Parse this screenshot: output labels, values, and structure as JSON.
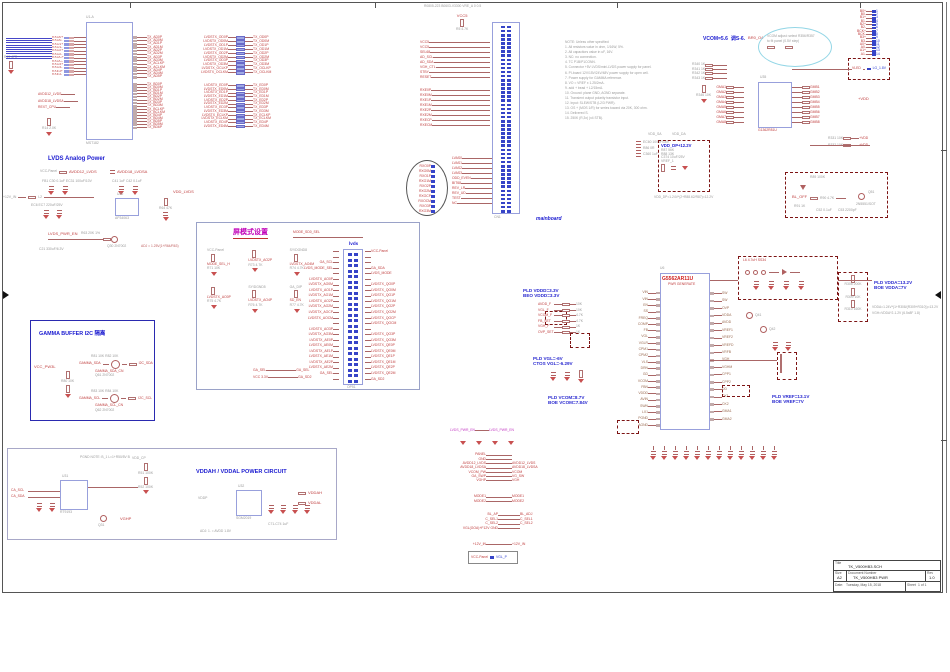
{
  "sheet": {
    "edge_res": "R19 47R"
  },
  "top_left_ic": {
    "ref": "U1-A",
    "part": "MST182",
    "bus_rows": 10,
    "left_rows": [
      {
        "l": "RXO0+"
      },
      {
        "l": "RXO0-"
      },
      {
        "l": "RXO1+"
      },
      {
        "l": "RXO1-"
      },
      {
        "l": "RXO2+"
      },
      {
        "l": "RXO2-"
      },
      {
        "l": "RXOC+"
      },
      {
        "l": "RXOC-"
      },
      {
        "l": "RXO3+"
      },
      {
        "l": "RXO3-"
      },
      {
        "l": "RXE3+"
      },
      {
        "l": "RXE3-"
      }
    ],
    "left_nets": [
      "AVDD12_LVDS",
      "AVDD18_LVDSA",
      "REXT_CPU"
    ],
    "rext": "R14 2.0K",
    "right1": [
      "TX_AD0P",
      "TX_AD0M",
      "TX_AD1P",
      "TX_AD1M",
      "TX_AD2P",
      "TX_AD2M",
      "TX_AD3P",
      "TX_AD3M",
      "TX_ACLKP",
      "TX_ACLKM",
      "TX_AD4P",
      "TX_AD4M",
      "TX_AD5P"
    ],
    "right2": [
      "TX_BD0P",
      "TX_BD0M",
      "TX_BD1P",
      "TX_BD1M",
      "TX_BD2P",
      "TX_BD2M",
      "TX_BD3P",
      "TX_BD3M",
      "TX_BCLKP",
      "TX_BCLKM",
      "TX_BD4P",
      "TX_BD4M",
      "TX_BD5P",
      "TX_BD5M",
      "TX_BD6P"
    ]
  },
  "rn1": [
    {
      "l": "LVDSTX_OD0P",
      "r": "TX_OD0P"
    },
    {
      "l": "LVDSTX_OD0M",
      "r": "TX_OD0M"
    },
    {
      "l": "LVDSTX_OD1P",
      "r": "TX_OD1P"
    },
    {
      "l": "LVDSTX_OD1M",
      "r": "TX_OD1M"
    },
    {
      "l": "LVDSTX_OD2P",
      "r": "TX_OD2P"
    },
    {
      "l": "LVDSTX_OD2M",
      "r": "TX_OD2M"
    },
    {
      "l": "LVDSTX_OD3P",
      "r": "TX_OD3P"
    },
    {
      "l": "LVDSTX_OD3M",
      "r": "TX_OD3M"
    },
    {
      "l": "LVDSTX_OCLKP",
      "r": "TX_OCLKP"
    },
    {
      "l": "LVDSTX_OCLKM",
      "r": "TX_OCLKM"
    }
  ],
  "rn2": [
    {
      "l": "LVDSTX_ED0P",
      "r": "TX_ED0P"
    },
    {
      "l": "LVDSTX_ED0M",
      "r": "TX_ED0M"
    },
    {
      "l": "LVDSTX_ED1P",
      "r": "TX_ED1P"
    },
    {
      "l": "LVDSTX_ED1M",
      "r": "TX_ED1M"
    },
    {
      "l": "LVDSTX_ED2P",
      "r": "TX_ED2P"
    },
    {
      "l": "LVDSTX_ED2M",
      "r": "TX_ED2M"
    },
    {
      "l": "LVDSTX_ED3P",
      "r": "TX_ED3P"
    },
    {
      "l": "LVDSTX_ED3M",
      "r": "TX_ED3M"
    },
    {
      "l": "LVDSTX_ECLKP",
      "r": "TX_ECLKP"
    },
    {
      "l": "LVDSTX_ECLKM",
      "r": "TX_ECLKM"
    },
    {
      "l": "LVDSTX_ED4P",
      "r": "TX_ED4P"
    },
    {
      "l": "LVDSTX_ED4M",
      "r": "TX_ED4M"
    }
  ],
  "main_conn": {
    "top_note": "R0805-223  B0603-V3300  VRE_A  0  0.5",
    "vcc": "VCC5",
    "vres": "R5 4.7K",
    "pins": 46,
    "label": "mainboard",
    "ref": "CN1",
    "left1": [
      "VCC5",
      "VCC5",
      "SEL68",
      "AD_SCL",
      "AD_SDA",
      "VGH_CTL",
      "STBY",
      "RESET"
    ],
    "left2": [
      "RXE0P",
      "RXE0M",
      "RXE1P",
      "RXE1M",
      "RXE2P",
      "RXE2M",
      "RXECP",
      "RXECM"
    ],
    "circle": [
      "RXO0P",
      "RXO0M",
      "RXO1P",
      "RXO1M",
      "RXO2P",
      "RXO2M",
      "RXOCP",
      "RXOCM",
      "RXO3P",
      "RXO3M"
    ],
    "lower": [
      "LVAS0",
      "LVAS1",
      "LVAS2",
      "LVAS3",
      "ODD_EVEN",
      "BIT68",
      "REV_LR",
      "REV_UD",
      "TEST",
      "NC"
    ]
  },
  "notes": [
    "NOTE: Unless other specified:",
    "1. All resistors value in ohm, 1/16W, 5%.",
    "2. All capacitors value in uF, 16V.",
    "3. NC: no connection.",
    "4. TC P1B/P1CONN.",
    "5. Connector +5V LVDS/mini-LVDS power supply for panel.",
    "6. PI-board 12V/15V/24V/48V power supply for open cell.",
    "7. Power supply for GAMMA reference.",
    "8. VO = VREF x 1.25/2mA.",
    "9. add + bead + L2/15mA.",
    "10. Ground: plane GND, AGND separate.",
    "11. Transient output polarity transistor input.",
    "12. Input: SLEW/STB (L2/3 PWR).",
    "13. OS + (MOS 1/R) for series toward via 20K, 300 ohm.",
    "14. Delivered S.",
    "15. 250K (R,3x) (x4 STB)."
  ],
  "lvds_power": {
    "title": "LVDS Analog Power",
    "c1_top": "VCC-Panel",
    "c1_net": "AVDD12_LVDS",
    "c1_parts": "FB1  C30 0.1uF  EC31 100uF/10V",
    "c2_net": "AVDD18_LVDSA",
    "c2_parts": "C41 1uF  C42 0.1uF",
    "dc_in": "+12V_IN",
    "bead": "L2",
    "caps": "EC6 EC7 220uF/25V",
    "ic_ref": "U30",
    "ic_part": "AP34063",
    "en": "LVDS_PWR_EN",
    "q": "Q30 2N7002",
    "r1": "R63 20K 1%",
    "r2": "R64 47K",
    "note": "ADJ = 1.25V(1+R64/R63)",
    "cout": "C21 330uF/6.3V",
    "out": "VDD_LVDS"
  },
  "gamma": {
    "title": "GAMMA  BUFFER  I2C  隔离",
    "vcc": "VCC_PW3L",
    "r_pull": "R80 10K",
    "rows": [
      {
        "refs": "R81 10K   R82 10K",
        "q": "Q61 2N7002",
        "in": "GAMMA_SDA",
        "out": "I2C_SDA",
        "sub": "GAMMA_SDA_CN"
      },
      {
        "refs": "R83 10K   R84 10K",
        "q": "Q62 2N7002",
        "in": "GAMMA_SCL",
        "out": "I2C_SCL",
        "sub": "GAMMA_SCL_CN"
      }
    ]
  },
  "mode": {
    "title": "屏模式设置",
    "title_net": "MODE_SD0_SEL",
    "conn_label": "lvds",
    "conn_ref": "OP51",
    "pins": 24,
    "left_labels": [
      "",
      "",
      "GA_SCL",
      "LVDS_MODE_SEL",
      "",
      "LVDSTX_AO0P",
      "LVDSTX_AO0M",
      "LVDSTX_AO1P",
      "LVDSTX_AO1M",
      "LVDSTX_AO2P",
      "LVDSTX_AO2M",
      "LVDSTX_AOCP",
      "LVDSTX_AOCM",
      "",
      "LVDSTX_AO3P",
      "LVDSTX_AO3M",
      "LVDSTX_AE0P",
      "LVDSTX_AE0M",
      "LVDSTX_AE1P",
      "LVDSTX_AE1M",
      "LVDSTX_AE2P",
      "LVDSTX_AE2M",
      "GA_SEL",
      ""
    ],
    "right_labels": [
      "VCC-Panel",
      "",
      "",
      "GA_SDA",
      "LVDS_MODE",
      "",
      "LVDSTX_QO0P",
      "LVDSTX_QO0M",
      "LVDSTX_QO1P",
      "LVDSTX_QO1M",
      "LVDSTX_QO2P",
      "LVDSTX_QO2M",
      "LVDSTX_QOCP",
      "LVDSTX_QOCM",
      "",
      "LVDSTX_QO3P",
      "LVDSTX_QO3M",
      "LVDSTX_QE0P",
      "LVDSTX_QE0M",
      "LVDSTX_QE1P",
      "LVDSTX_QE1M",
      "LVDSTX_QE2P",
      "LVDSTX_QE2M",
      "GA_SD2"
    ],
    "pulls": [
      {
        "top": "VCC-Panel",
        "r": "R71 10K",
        "net": "MODE_SEL_H"
      },
      {
        "top": "",
        "r": "R73 4.7K",
        "net": "LVDSTX_AO2P"
      },
      {
        "top": "SY/DGND8",
        "r": "R74 4.7K",
        "net": "LVDSTX_AO4M"
      },
      {
        "top": "",
        "r": "R75 4.7K",
        "net": "LVDSTX_AO0P"
      },
      {
        "top": "SY/DGND5",
        "r": "R76 4.7K",
        "net": "LVDSTX_AO4P"
      },
      {
        "top": "GA_DIP",
        "r": "R77 4.7K",
        "net": "SD_EN"
      }
    ],
    "bot_rows": [
      {
        "l": "GA_SEL",
        "r": "GA_SEL"
      },
      {
        "l": "VCC 3.3V",
        "r": "GA_SD2"
      }
    ]
  },
  "vddah": {
    "title": "VDDAH / VDDAL POWER CIRCUIT",
    "note": "PGND NOTE: B_1   L=1+R50/5V B",
    "in1": "CA_SCL",
    "in2": "CA_SDA",
    "ic1_ref": "U31",
    "ic1_part": "RT9193",
    "vddcp": "VDD_CP",
    "r1": "R51 100K",
    "r2": "R52 100K",
    "out_l": "VGHP",
    "q": "Q31",
    "in_r": "VDDP",
    "ic2_ref": "U32",
    "ic2_part": "SGM2019",
    "caps": "C71-C74 1uF",
    "out1": "VDDAH",
    "out2": "VDDAL",
    "note2": "ADJ: 1. = AVDD 1.8V"
  },
  "g5562": {
    "ref": "U6",
    "part": "G5562AR11U",
    "sub": "PWR GENERATE",
    "left_pins": [
      "VIN",
      "VIN",
      "EN",
      "SS",
      "FREQ",
      "COMP",
      "FB",
      "VGL",
      "VGLR",
      "CPM1",
      "CPM2",
      "VLS",
      "DRN",
      "GD",
      "VCOM",
      "FBN",
      "VDDD",
      "AVIN",
      "SWN",
      "LX1",
      "PGND",
      "AGND"
    ],
    "right_pins": [
      "SW",
      "SW",
      "OVP",
      "VDDA",
      "AVDD",
      "VREF1",
      "VREF2",
      "VREFD",
      "VRFB",
      "VGH",
      "VGHM",
      "CPP1",
      "CPP2",
      "DD",
      "CK1",
      "CK2",
      "GMA1",
      "GMA2"
    ],
    "annotations": [
      {
        "l1": "PLD  VDDD=3.3V",
        "l2": "BEO VDDD=3.3V"
      },
      {
        "l1": "PLD  VGL=-6V",
        "l2": "CTOS VGL=-6.29V"
      },
      {
        "l1": "PLD  VCOM=8.7V",
        "l2": "BOE VCOM=7.84V"
      },
      {
        "l1": "PLD  VDDA=13.2V",
        "l2": "BOE VDDA=7V"
      },
      {
        "l1": "PLD  VREF=13.1V",
        "l2": "BOE VREF=7V"
      }
    ],
    "boost_label": "L6 4.7uH   SS34",
    "r_divider": [
      "R308 200K",
      "R309 10K",
      "R310 160K"
    ],
    "note1": "VDDA=1.24V*(1+R308/(R309+R310))=13.2V",
    "note2": "VGH=VDDA*2-1.2V  (6.5x8F 1.8)",
    "left_misc": [
      {
        "l": "AVDD_F",
        "r": "10K"
      },
      {
        "l": "VGL_F",
        "r": "10K"
      },
      {
        "l": "VCOM_F",
        "r": "4.7K"
      },
      {
        "l": "FB_SET",
        "r": "4.7K"
      },
      {
        "l": "VGH_F",
        "r": "1K"
      },
      {
        "l": "OVP_SET",
        "r": "1K"
      }
    ],
    "bottom_caps": 12,
    "q1": "Q41",
    "q2": "Q42"
  },
  "bottom_conn": {
    "g1": [
      {
        "l": "LVDS_PWR_EN",
        "r": "LVDS_PWR_EN"
      }
    ],
    "g2": [
      {
        "l": "PANEL",
        "r": ""
      },
      {
        "l": "GND",
        "r": ""
      },
      {
        "l": "AVDD12_LVDS",
        "r": "AVDD12_LVDS"
      },
      {
        "l": "AVDD18_LVDSA",
        "r": "AVDD18_LVDSA"
      },
      {
        "l": "VCOM_PW",
        "r": "VCOM"
      },
      {
        "l": "GA_SWP",
        "r": "VG_SW"
      },
      {
        "l": "VGHP",
        "r": "VGH"
      }
    ],
    "g3": [
      {
        "l": "MODE1",
        "r": "MODE1"
      },
      {
        "l": "MODE2",
        "r": "MODE2"
      }
    ],
    "g4": [
      {
        "l": "BL_AP",
        "r": "BL_ADJ"
      },
      {
        "l": "C_SEL1",
        "r": "C_SEL1"
      },
      {
        "l": "C_SEL2",
        "r": "C_SEL2"
      },
      {
        "l": "VGL(GOA)+F12V GND",
        "r": ""
      }
    ],
    "g5": [
      {
        "l": "+12V_IN",
        "r": "+12V_IN"
      }
    ],
    "box": {
      "l": "VCC-Panel",
      "r": "VGL_P"
    }
  },
  "vcom": {
    "head_blue": "VCOM=5.6",
    "head_mid": "调S-6.",
    "head_red": "BR0_O4",
    "ellipse_note1": "VCOM adjust: select R356/R357",
    "ellipse_note2": "to fit panel (0.5V step)",
    "tr_rows": [
      {
        "l": "B0+",
        "r": "1"
      },
      {
        "l": "B0-",
        "r": "2"
      },
      {
        "l": "B1+",
        "r": "3"
      },
      {
        "l": "B1-",
        "r": "4"
      },
      {
        "l": "B2+",
        "r": "5"
      },
      {
        "l": "B2-",
        "r": "6"
      },
      {
        "l": "BCK+",
        "r": "7"
      },
      {
        "l": "BCK-",
        "r": "8"
      },
      {
        "l": "B3+",
        "r": "9"
      },
      {
        "l": "B3-",
        "r": "10"
      },
      {
        "l": "A0+",
        "r": "11"
      },
      {
        "l": "A0-",
        "r": "12"
      },
      {
        "l": "A1+",
        "r": "13"
      },
      {
        "l": "A1-",
        "r": "14"
      }
    ],
    "tr_box": {
      "l": "VLED",
      "r": "LG_1.8V"
    },
    "ic_ref": "U35",
    "ic_part": "G1362R81U",
    "left_a": [
      "R340 1K",
      "R341 1K",
      "R342 1K",
      "R343 1K"
    ],
    "pull": "R346 10K",
    "left_b": [
      {
        "l": "GMA1"
      },
      {
        "l": "GMA2"
      },
      {
        "l": "GMA3"
      },
      {
        "l": "GMA4"
      },
      {
        "l": "GMA5"
      },
      {
        "l": "GMA6"
      },
      {
        "l": "GMA7"
      },
      {
        "l": "GMA8"
      }
    ],
    "right_b": [
      {
        "r": "GMB1"
      },
      {
        "r": "GMB2"
      },
      {
        "r": "GMB3"
      },
      {
        "r": "GMB4"
      },
      {
        "r": "GMB5"
      },
      {
        "r": "GMB6"
      },
      {
        "r": "GMB7"
      },
      {
        "r": "GMB8"
      }
    ],
    "vdd": "+VDD",
    "vdd_sa": "VDD_SA",
    "vdd_da": "VDD_DA",
    "caps_left": [
      "EC60 100uF/16V",
      "R86 0R",
      "C360 1uF"
    ],
    "dp": {
      "title": "VDD_DP+12.2V",
      "parts": [
        "R87 56K",
        "R88 13K",
        "C374 10uF/25V",
        "VREF_1"
      ],
      "formula": "VDD_DP=1.24V*(2+R88.62/R87)=12.2V"
    },
    "right_mid": [
      {
        "l": "R331 10K",
        "r": "+VDD"
      },
      {
        "l": "R332 10K",
        "r": "+VDD"
      }
    ],
    "bl": {
      "zd": "ZD51 5.1V",
      "net": "BL_OFF",
      "r1": "R90 4.7K",
      "r2": "R91 1K",
      "c": "C52 0.1uF",
      "q": "Q51",
      "q_part": "2N5551/SOT",
      "rt": "R89 100K",
      "cap2": "C53 2200pF"
    }
  },
  "titleblock": {
    "title_label": "Title",
    "title": "TK_V500HB3.SCH",
    "size_label": "Size",
    "size": "A2",
    "doc_label": "Document Number",
    "doc": "TK_V500HB3  PWR",
    "rev_label": "Rev",
    "rev": "1.0",
    "date_label": "Date:",
    "date": "Tuesday, May 15, 2018",
    "sheet_label": "Sheet",
    "sheet": "1  of  1"
  }
}
